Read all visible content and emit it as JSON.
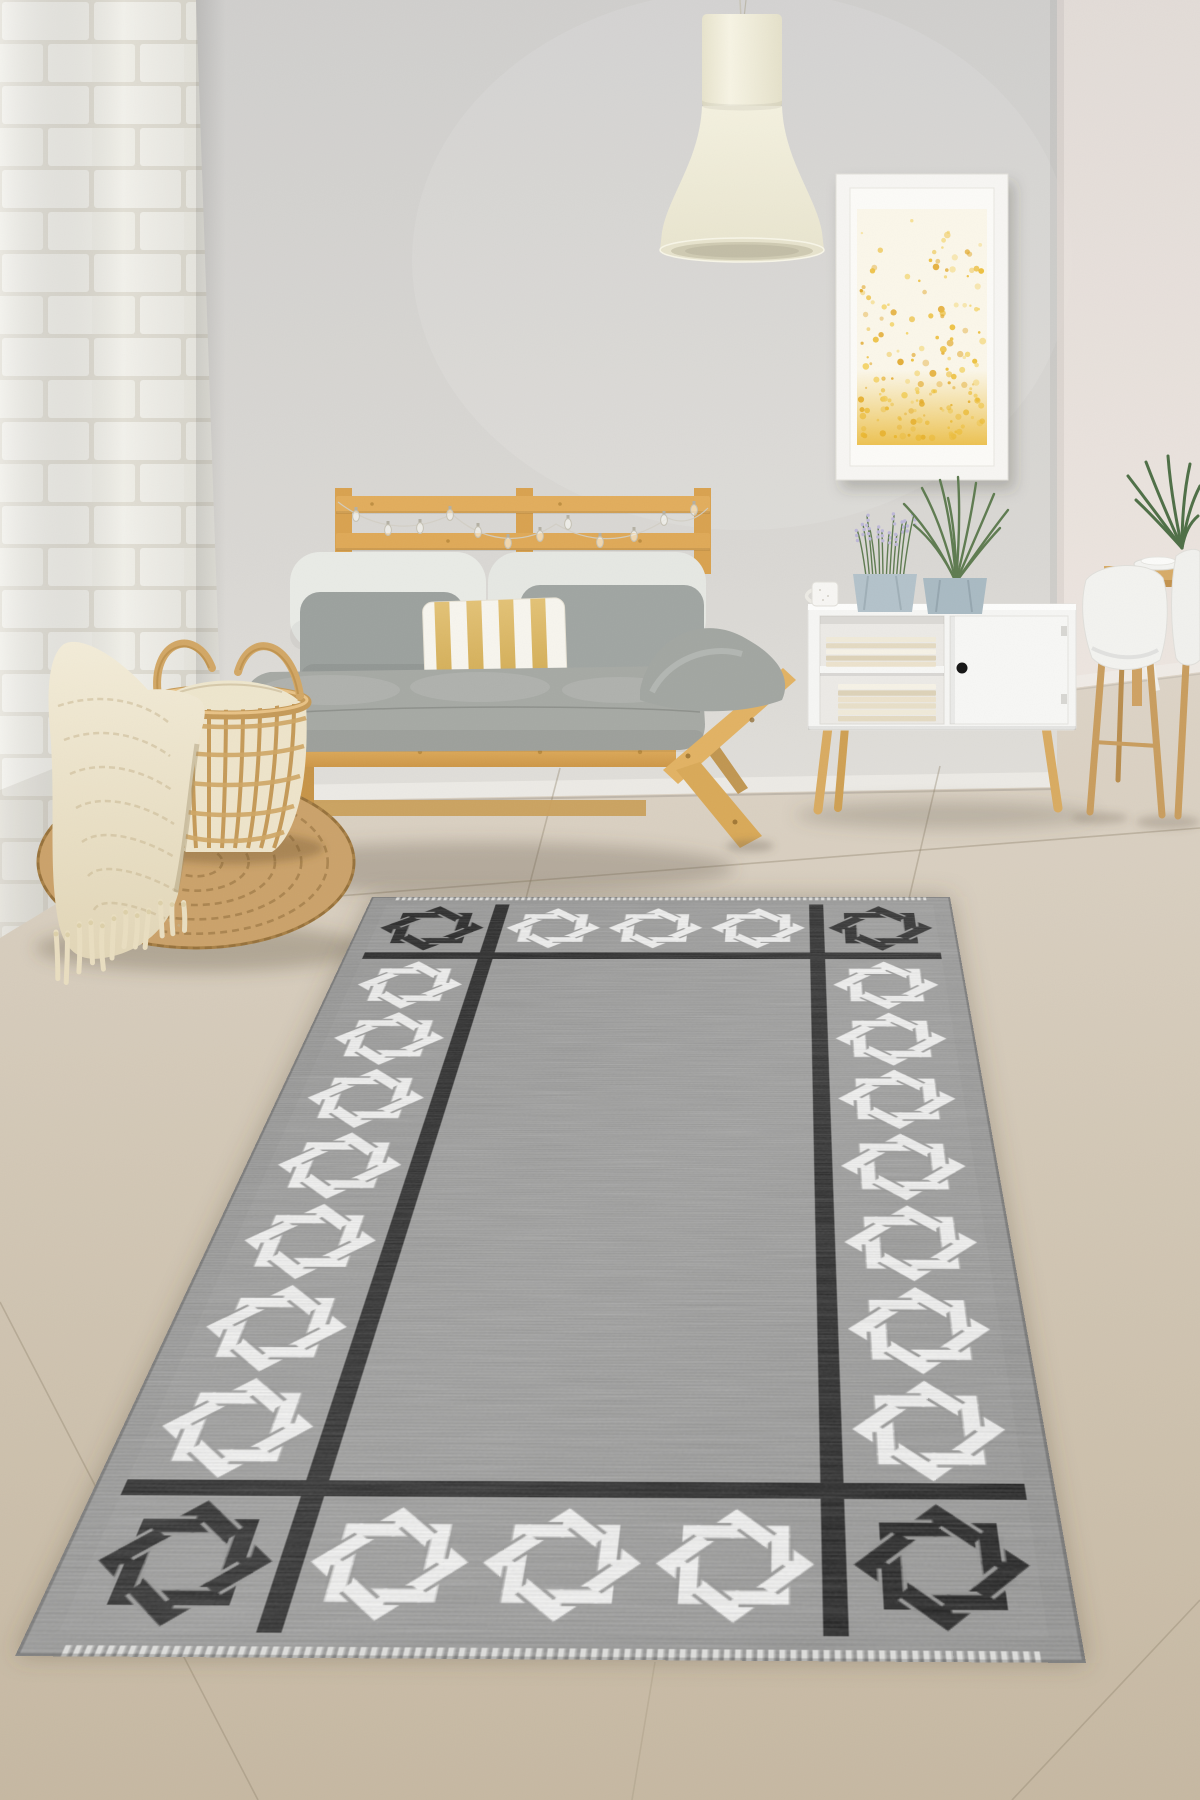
{
  "scene": {
    "type": "product-photo",
    "subject": "Gray area rug with black and white interlaced knot border in a Scandinavian living room",
    "width": 1200,
    "height": 1800
  },
  "palette": {
    "wall": "#d5d4d1",
    "wall_warm": "#ece2dc",
    "brick": "#f2f1eb",
    "mortar": "#e2dfd5",
    "floor_far": "#ddd4c7",
    "floor_near": "#c6b8a2",
    "baseboard": "#eceae5",
    "wood": "#e0ab5c",
    "wood_dark": "#bf8c3e",
    "lamp_cream": "#f0eddc",
    "cushion_white": "#e9ebe6",
    "pillow_gray": "#9da29f",
    "seat_gray": "#a5a8a3",
    "stripe_gold": "#d8b766",
    "cabinet_white": "#f5f5f3",
    "pot_blue": "#aebfc8",
    "plant_green": "#5e7b50",
    "lavender": "#bdb7d8",
    "jute": "#c9a061",
    "blanket_cream": "#ece4cb",
    "art_gold": "#edbe38"
  },
  "objects": {
    "rug": {
      "field": "#8f8e8c",
      "black": "#161616",
      "white": "#f7f7f6",
      "motif": "interlaced-knot-square",
      "corner_motifs": 4,
      "top_motifs": 3,
      "bottom_motifs": 3,
      "side_motifs_per_side": 7,
      "border_style": "black grid bands isolating a motif border around a plain heathered field"
    },
    "artwork": {
      "frame": "#f7f6f3",
      "dots": [
        "#edbe38",
        "#f4d469",
        "#e2a82a"
      ],
      "dot_count": 170,
      "style": "gold speckles denser toward the bottom"
    },
    "lamp": {
      "color": "#f0eddc",
      "shape": "industrial pendant, cylinder top with bell shade"
    },
    "sofa": {
      "frame": "pine pallet futon",
      "back_cushions": "white",
      "pillows": "gray",
      "accent_pillow": "white with gold vertical stripes",
      "lights": "string of small glass bulbs on headboard"
    },
    "sideboard": {
      "color": "#f5f5f3",
      "knob": "#141414",
      "contents": "stacked beige books on two shelves",
      "top_items": [
        "white mug",
        "lavender in gray fabric pot",
        "dracaena in gray fabric pot"
      ]
    },
    "dining": {
      "chairs": "white shell chairs with wood legs",
      "table": "light wood",
      "decor": [
        "white plates",
        "green plant"
      ]
    },
    "left_decor": {
      "pouf": "round woven jute",
      "basket": "open rattan basket holding cream chunky blanket",
      "throw": "cream knit throw with tassels draped over basket"
    }
  }
}
